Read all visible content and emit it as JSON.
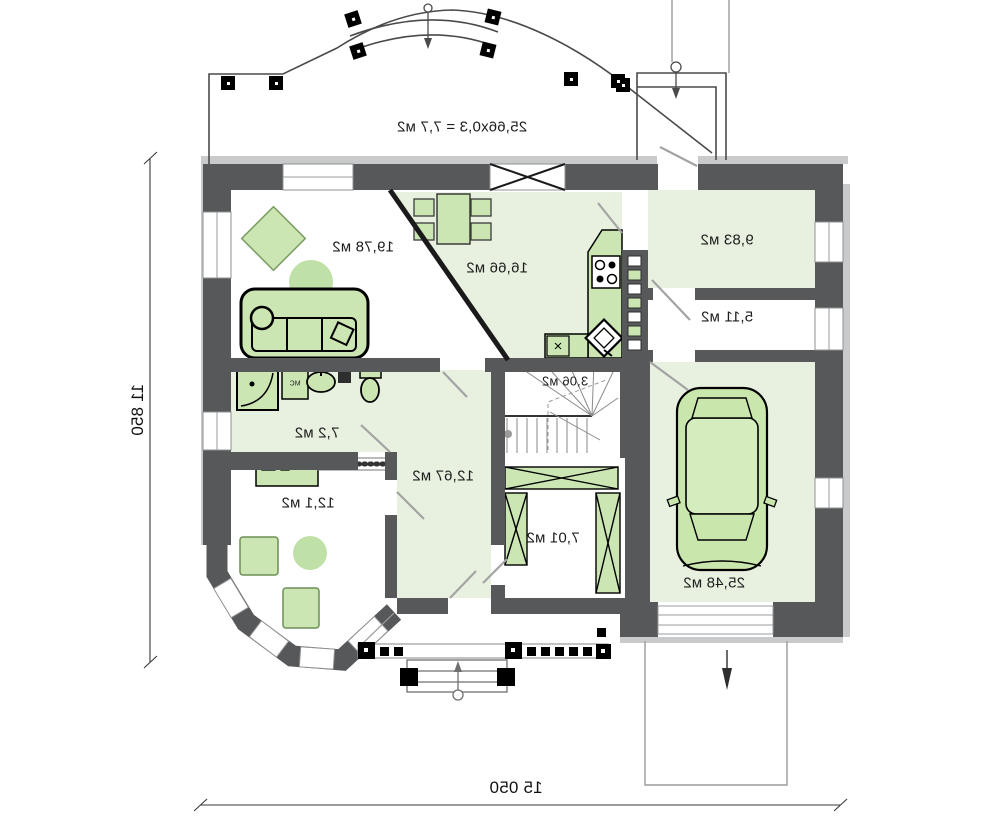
{
  "plan_type": "floor-plan",
  "rooms": {
    "living_room": {
      "label": "19,78 м2"
    },
    "kitchen_dining": {
      "label": "16,66 м2"
    },
    "entry_hall": {
      "label": "9,83 м2"
    },
    "pantry": {
      "label": "5,11 м2"
    },
    "staircase": {
      "label": "3,06 м2"
    },
    "bathroom": {
      "label": "7,2 м2"
    },
    "hallway": {
      "label": "12,67 м2"
    },
    "office": {
      "label": "12,1 м2"
    },
    "utility": {
      "label": "7,01 м2"
    },
    "garage": {
      "label": "25,48 м2"
    }
  },
  "annotations": {
    "terrace_area_calc": "25,66x0,3 = 7,7 м2",
    "washer_label": "МС"
  },
  "dimensions": {
    "overall_width": "15 050",
    "overall_height": "11 850"
  },
  "colors": {
    "wall": "#57585a",
    "trim": "#c9cacb",
    "floor_green": "#e8f1e0",
    "furniture_green": "#cbe6b3",
    "rug_green": "#bfe0a6"
  }
}
